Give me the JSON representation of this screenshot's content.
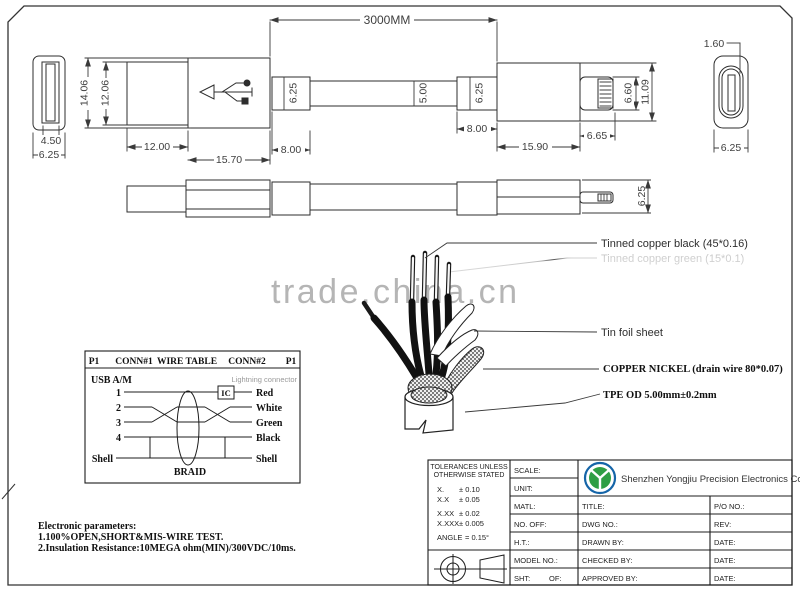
{
  "watermark": {
    "text": "trade.china.cn"
  },
  "dims": {
    "overall": "3000MM",
    "usb_tongue_w": "4.50",
    "usb_outer_w": "6.25",
    "usb_mold_h": "14.06",
    "usb_shell_h": "12.06",
    "usb_shell_len": "12.00",
    "usb_mold_len": "15.70",
    "left_relief_h": "6.25",
    "left_relief_len": "8.00",
    "cable_od": "5.00",
    "right_relief_h": "6.25",
    "right_relief_len": "8.00",
    "right_mold_len": "15.90",
    "pin_len": "6.65",
    "pin_h": "6.60",
    "right_mold_h": "11.09",
    "end_tongue_w": "1.60",
    "end_body_w": "6.25",
    "side_view_h": "6.25"
  },
  "callouts": {
    "copper_black": "Tinned copper black (45*0.16)",
    "copper_green": "Tinned copper green (15*0.1)",
    "tin_foil": "Tin foil sheet",
    "copper_nickel": "COPPER NICKEL (drain wire 80*0.07)",
    "tpe": "TPE OD 5.00mm±0.2mm"
  },
  "wire_table": {
    "header": {
      "p1_left": "P1",
      "conn1": "CONN#1",
      "title": "WIRE TABLE",
      "conn2": "CONN#2",
      "p1_right": "P1"
    },
    "left_connector": "USB A/M",
    "right_connector": "Lightning connector",
    "ic": "IC",
    "braid": "BRAID",
    "rows": [
      {
        "pin": "1",
        "color": "Red"
      },
      {
        "pin": "2",
        "color": "White"
      },
      {
        "pin": "3",
        "color": "Green"
      },
      {
        "pin": "4",
        "color": "Black"
      },
      {
        "pin": "Shell",
        "color": "Shell"
      }
    ]
  },
  "electronic_parameters": {
    "title": "Electronic parameters:",
    "items": [
      "1.100%OPEN,SHORT&MIS-WIRE TEST.",
      "2.Insulation Resistance:10MEGA ohm(MIN)/300VDC/10ms."
    ]
  },
  "title_block": {
    "tolerances": {
      "heading_line1": "TOLERANCES UNLESS",
      "heading_line2": "OTHERWISE STATED",
      "rows": [
        {
          "label": "X.",
          "value": "± 0.10"
        },
        {
          "label": "X.X",
          "value": "± 0.05"
        },
        {
          "label": "X.XX",
          "value": "± 0.02"
        },
        {
          "label": "X.XXX",
          "value": "± 0.005"
        },
        {
          "label": "ANGLE",
          "value": "= 0.15°"
        }
      ]
    },
    "fields": {
      "scale": "SCALE:",
      "unit": "UNIT:",
      "matl": "MATL:",
      "no_off": "NO. OFF:",
      "ht": "H.T.:",
      "model_no": "MODEL NO.:",
      "sht": "SHT:",
      "of": "OF:",
      "title": "TITLE:",
      "po_no": "P/O NO.:",
      "dwg_no": "DWG NO.:",
      "rev": "REV:",
      "drawn_by": "DRAWN BY:",
      "checked_by": "CHECKED BY:",
      "approved_by": "APPROVED BY:",
      "date": "DATE:"
    },
    "company": "Shenzhen Yongjiu Precision Electronics Co.,Ltd",
    "colors": {
      "logo_blue": "#1565a8",
      "logo_green": "#2f9e44"
    }
  }
}
